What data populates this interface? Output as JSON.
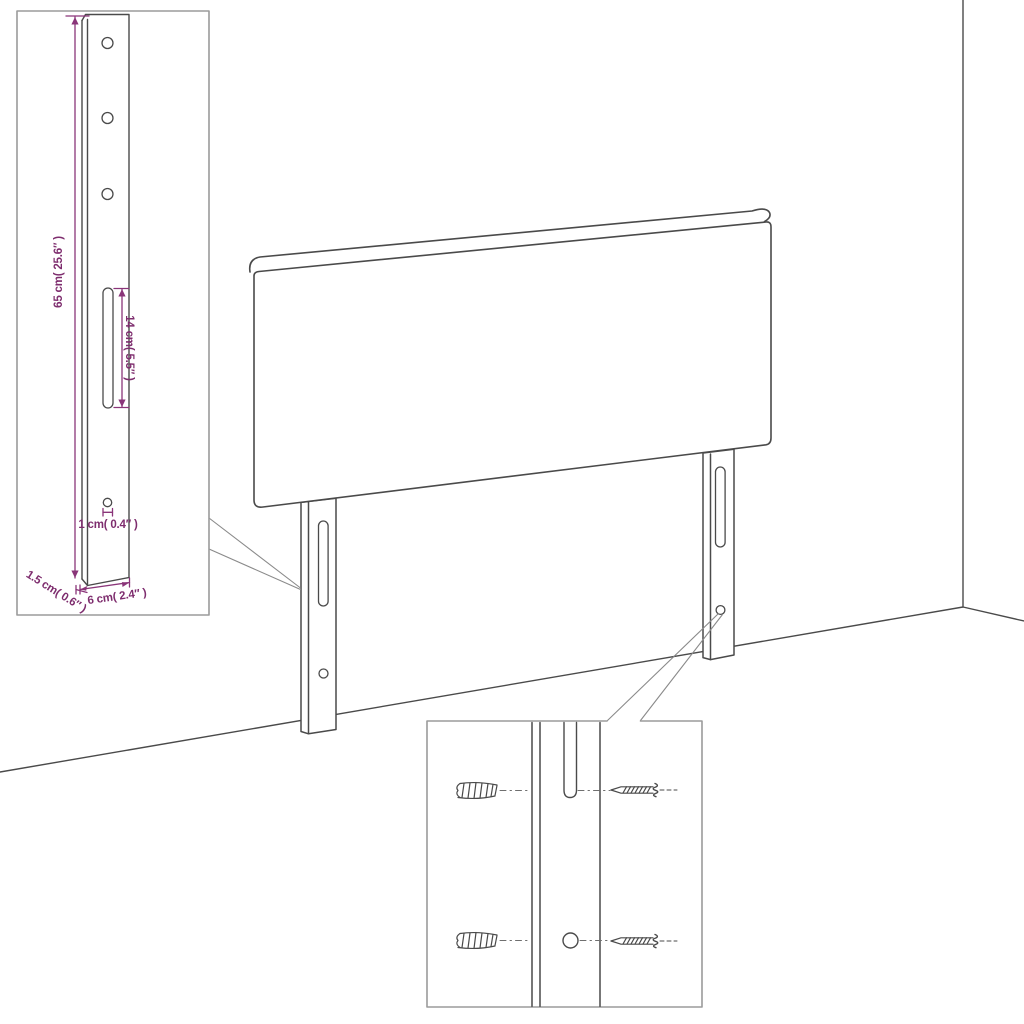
{
  "colors": {
    "background": "#ffffff",
    "outline": "#4a4a4a",
    "dimension_text": "#7e2d6e",
    "dimension_line": "#8a3579",
    "inset_border": "#9b9b9b",
    "callout_line": "#8a8a8a"
  },
  "main_drawing": {
    "subject": "headboard-with-two-legs-against-wall-corner",
    "parts": [
      "headboard-panel",
      "left-leg",
      "right-leg",
      "leg-slot",
      "leg-screw-hole",
      "wall-corner",
      "floor-line"
    ]
  },
  "inset_leg_detail": {
    "subject": "leg-dimension-detail",
    "height_label": "65 cm( 25.6″ )",
    "slot_label": "14 cm( 5.5″ )",
    "hole_label": "1 cm( 0.4″ )",
    "thickness_label": "1.5 cm( 0.6″ )",
    "width_label": "6 cm( 2.4″ )"
  },
  "inset_mounting_detail": {
    "subject": "wall-mounting-close-up",
    "parts": [
      "wall-plug",
      "screw",
      "leg-slot",
      "leg-screw-hole"
    ]
  }
}
